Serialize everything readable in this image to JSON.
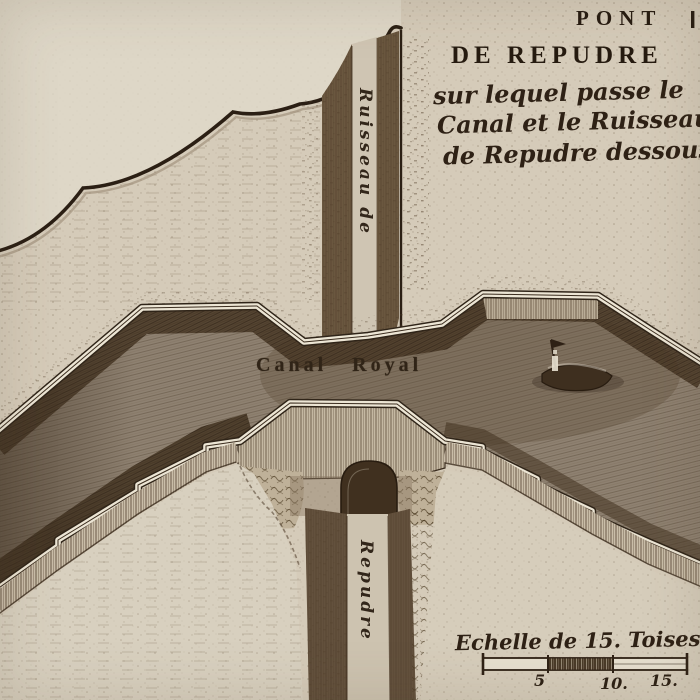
{
  "title": {
    "line1": "PONT",
    "line2": "DE REPUDRE"
  },
  "subtitle": {
    "line1": "sur lequel passe le",
    "line2": "Canal et le Ruisseau",
    "line3": "de Repudre dessous"
  },
  "labels": {
    "canal": "Canal Royal",
    "stream_upper": "Ruisseau de",
    "stream_lower": "Repudre"
  },
  "scale": {
    "caption": "Echelle de 15. Toises.",
    "ticks": [
      "5",
      "10.",
      "15."
    ]
  },
  "colors": {
    "paper": "#d5cbb9",
    "paper_light": "#ded7c7",
    "ink": "#2c2014",
    "water": "#8e8171",
    "bank_dark": "#4a3826",
    "highlight_band": "#ece5d4",
    "wall": "#c9bda8",
    "floodplain": "#d8d0bf"
  }
}
